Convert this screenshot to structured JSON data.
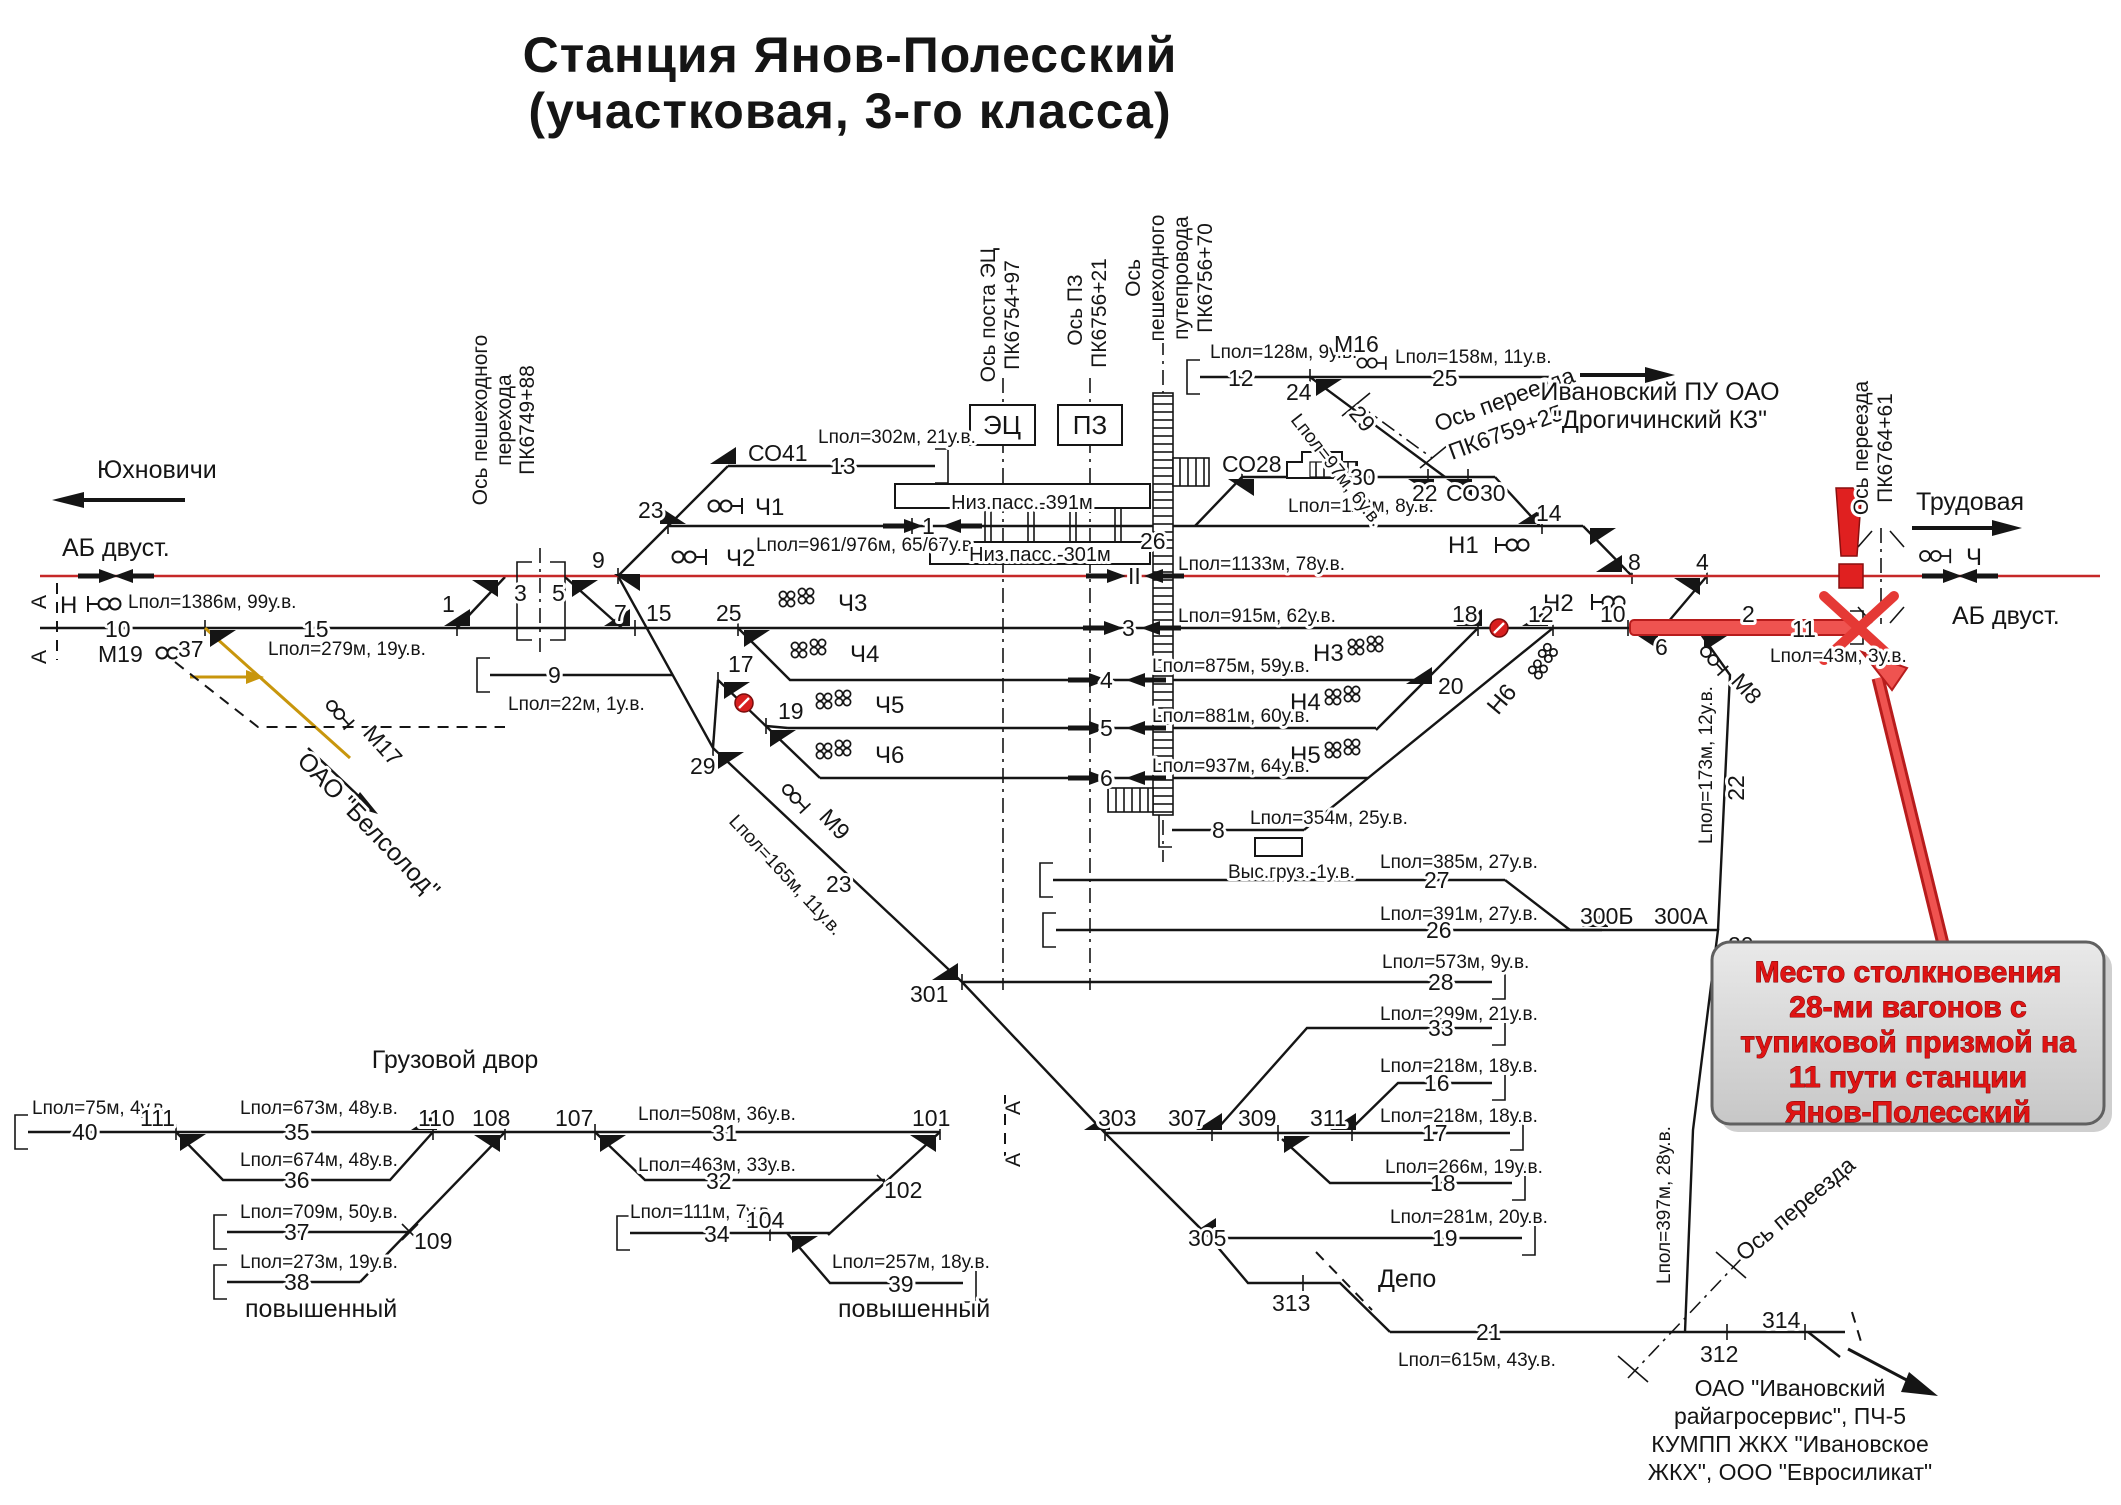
{
  "meta": {
    "diagram": "railway-station-scheme"
  },
  "colors": {
    "track": "#151515",
    "main_line_red": "#c62828",
    "incident_red": "#e53935",
    "yellow_track": "#c8960c",
    "callout_bg": "#d9d9d9",
    "callout_text": "#df1414"
  },
  "callout": {
    "l1": "Место столкновения",
    "l2": "28-ми вагонов с",
    "l3": "тупиковой призмой на",
    "l4": "11 пути станции",
    "l5": "Янов-Полесский"
  },
  "L": {
    "title1": "Станция Янов-Полесский",
    "title2": "(участковая, 3-го класса)",
    "yukh": "Юхновичи",
    "abL": "АБ двуст.",
    "abR": "АБ двуст.",
    "trud": "Трудовая",
    "nSig": "Н",
    "chR": "Ч",
    "lp1386": "Lпол=1386м, 99у.в.",
    "lp279": "Lпол=279м, 19у.в.",
    "lp22": "Lпол=22м, 1у.в.",
    "lp302": "Lпол=302м, 21у.в.",
    "lp961": "Lпол=961/976м, 65/67у.в.",
    "lp128": "Lпол=128м, 9у.в.",
    "lp158": "Lпол=158м, 11у.в.",
    "lp97": "Lпол=97м, 6у.в.",
    "lp113": "Lпол=113м, 8у.в.",
    "lp1133": "Lпол=1133м, 78у.в.",
    "lp915": "Lпол=915м, 62у.в.",
    "lp875": "Lпол=875м, 59у.в.",
    "lp881": "Lпол=881м, 60у.в.",
    "lp937": "Lпол=937м, 64у.в.",
    "lp354": "Lпол=354м, 25у.в.",
    "lp385": "Lпол=385м, 27у.в.",
    "lp391": "Lпол=391м, 27у.в.",
    "lp573": "Lпол=573м, 9у.в.",
    "lp299": "Lпол=299м, 21у.в.",
    "lp218a": "Lпол=218м, 18у.в.",
    "lp218b": "Lпол=218м, 18у.в.",
    "lp266": "Lпол=266м, 19у.в.",
    "lp281": "Lпол=281м, 20у.в.",
    "lp615": "Lпол=615м, 43у.в.",
    "lp43": "Lпол=43м, 3у.в.",
    "lp173": "Lпол=173м, 12у.в.",
    "lp397": "Lпол=397м, 28у.в.",
    "lp165": "Lпол=165м, 11у.в.",
    "lp75": "Lпол=75м, 4у.в.",
    "lp673": "Lпол=673м, 48у.в.",
    "lp674": "Lпол=674м, 48у.в.",
    "lp709": "Lпол=709м, 50у.в.",
    "lp273": "Lпол=273м, 19у.в.",
    "lp508": "Lпол=508м, 36у.в.",
    "lp463": "Lпол=463м, 33у.в.",
    "lp111": "Lпол=111м, 7у.в.",
    "lp257": "Lпол=257м, 18у.в.",
    "n10": "10",
    "m19": "М19",
    "n37": "37",
    "n15": "15",
    "n1": "1",
    "n3": "3",
    "n5": "5",
    "n9": "9",
    "n23": "23",
    "n7": "7",
    "n15sw": "15",
    "n25sw": "25",
    "n17": "17",
    "n19": "19",
    "n29": "29",
    "n9tr": "9",
    "aL1": "А",
    "aL2": "А",
    "aR1": "А",
    "aR2": "А",
    "ospe1": "Ось пешеходного",
    "ospe2": "перехода",
    "ospe3": "ПК6749+88",
    "oaoBel": "ОАО \"Белсолод\"",
    "m17": "М17",
    "m9": "М9",
    "m8": "М8",
    "m16": "М16",
    "n23d": "23",
    "co41": "СО41",
    "n13": "13",
    "ec": "ЭЦ",
    "pz": "ПЗ",
    "osec1": "Ось поста ЭЦ",
    "osec2": "ПК6754+97",
    "ospz1": "Ось ПЗ",
    "ospz2": "ПК6756+21",
    "osped1": "Ось",
    "osped2": "пешеходного",
    "osped3": "путепровода",
    "osped4": "ПК6756+70",
    "ch1": "Ч1",
    "ch2": "Ч2",
    "ch3": "Ч3",
    "ch4": "Ч4",
    "ch5": "Ч5",
    "ch6": "Ч6",
    "h1": "Н1",
    "h2": "Н2",
    "h3": "Н3",
    "h4": "Н4",
    "h5": "Н5",
    "h6": "Н6",
    "niz391": "Низ.пасс.-391м",
    "niz301": "Низ.пасс.-301м",
    "n26": "26",
    "co28": "СО28",
    "n30": "30",
    "n22sw": "22",
    "co30": "СО30",
    "n24": "24",
    "n12tr": "12",
    "n25tr": "25",
    "n29d": "29",
    "osper1": "Ось переезда",
    "osper2": "ПК6759+25",
    "ivan1": "Ивановский ПУ ОАО",
    "ivan2": "\"Дрогичинский КЗ\"",
    "n14": "14",
    "n8sw": "8",
    "n4sw": "4",
    "osper3": "Ось переезда",
    "osper4": "ПК6764+61",
    "nII": "II",
    "n3tr": "3",
    "n4tr": "4",
    "n5tr": "5",
    "n6tr": "6",
    "n1tr": "1",
    "n8tr": "8",
    "n18sw": "18",
    "n12sw": "12",
    "n10sw": "10",
    "n2sw": "2",
    "n6sw": "6",
    "n11": "11",
    "n20sw": "20",
    "vys": "Выс.груз.-1у.в.",
    "n27": "27",
    "n26b": "26",
    "n28": "28",
    "n33": "33",
    "n16": "16",
    "n17b": "17",
    "n18b": "18",
    "n19b": "19",
    "n21": "21",
    "n20tr": "20",
    "n22tr": "22",
    "n300b": "300Б",
    "n300a": "300А",
    "osper5": "Ось переезда",
    "n312": "312",
    "n314": "314",
    "n301": "301",
    "n303": "303",
    "n305": "305",
    "n307": "307",
    "n309": "309",
    "n311": "311",
    "n313": "313",
    "depo": "Депо",
    "comp1": "ОАО \"Ивановский",
    "comp2": "райагросервис\", ПЧ-5",
    "comp3": "КУМПП ЖКХ \"Ивановское",
    "comp4": "ЖКХ\", ООО \"Евросиликат\"",
    "gruz": "Грузовой двор",
    "n40": "40",
    "n111": "111",
    "n35": "35",
    "n110": "110",
    "n108": "108",
    "n36": "36",
    "n37b": "37",
    "n109": "109",
    "n38": "38",
    "povL": "повышенный",
    "povR": "повышенный",
    "n107": "107",
    "n31": "31",
    "n101": "101",
    "n32": "32",
    "n102": "102",
    "n34": "34",
    "n104": "104",
    "n39": "39"
  }
}
